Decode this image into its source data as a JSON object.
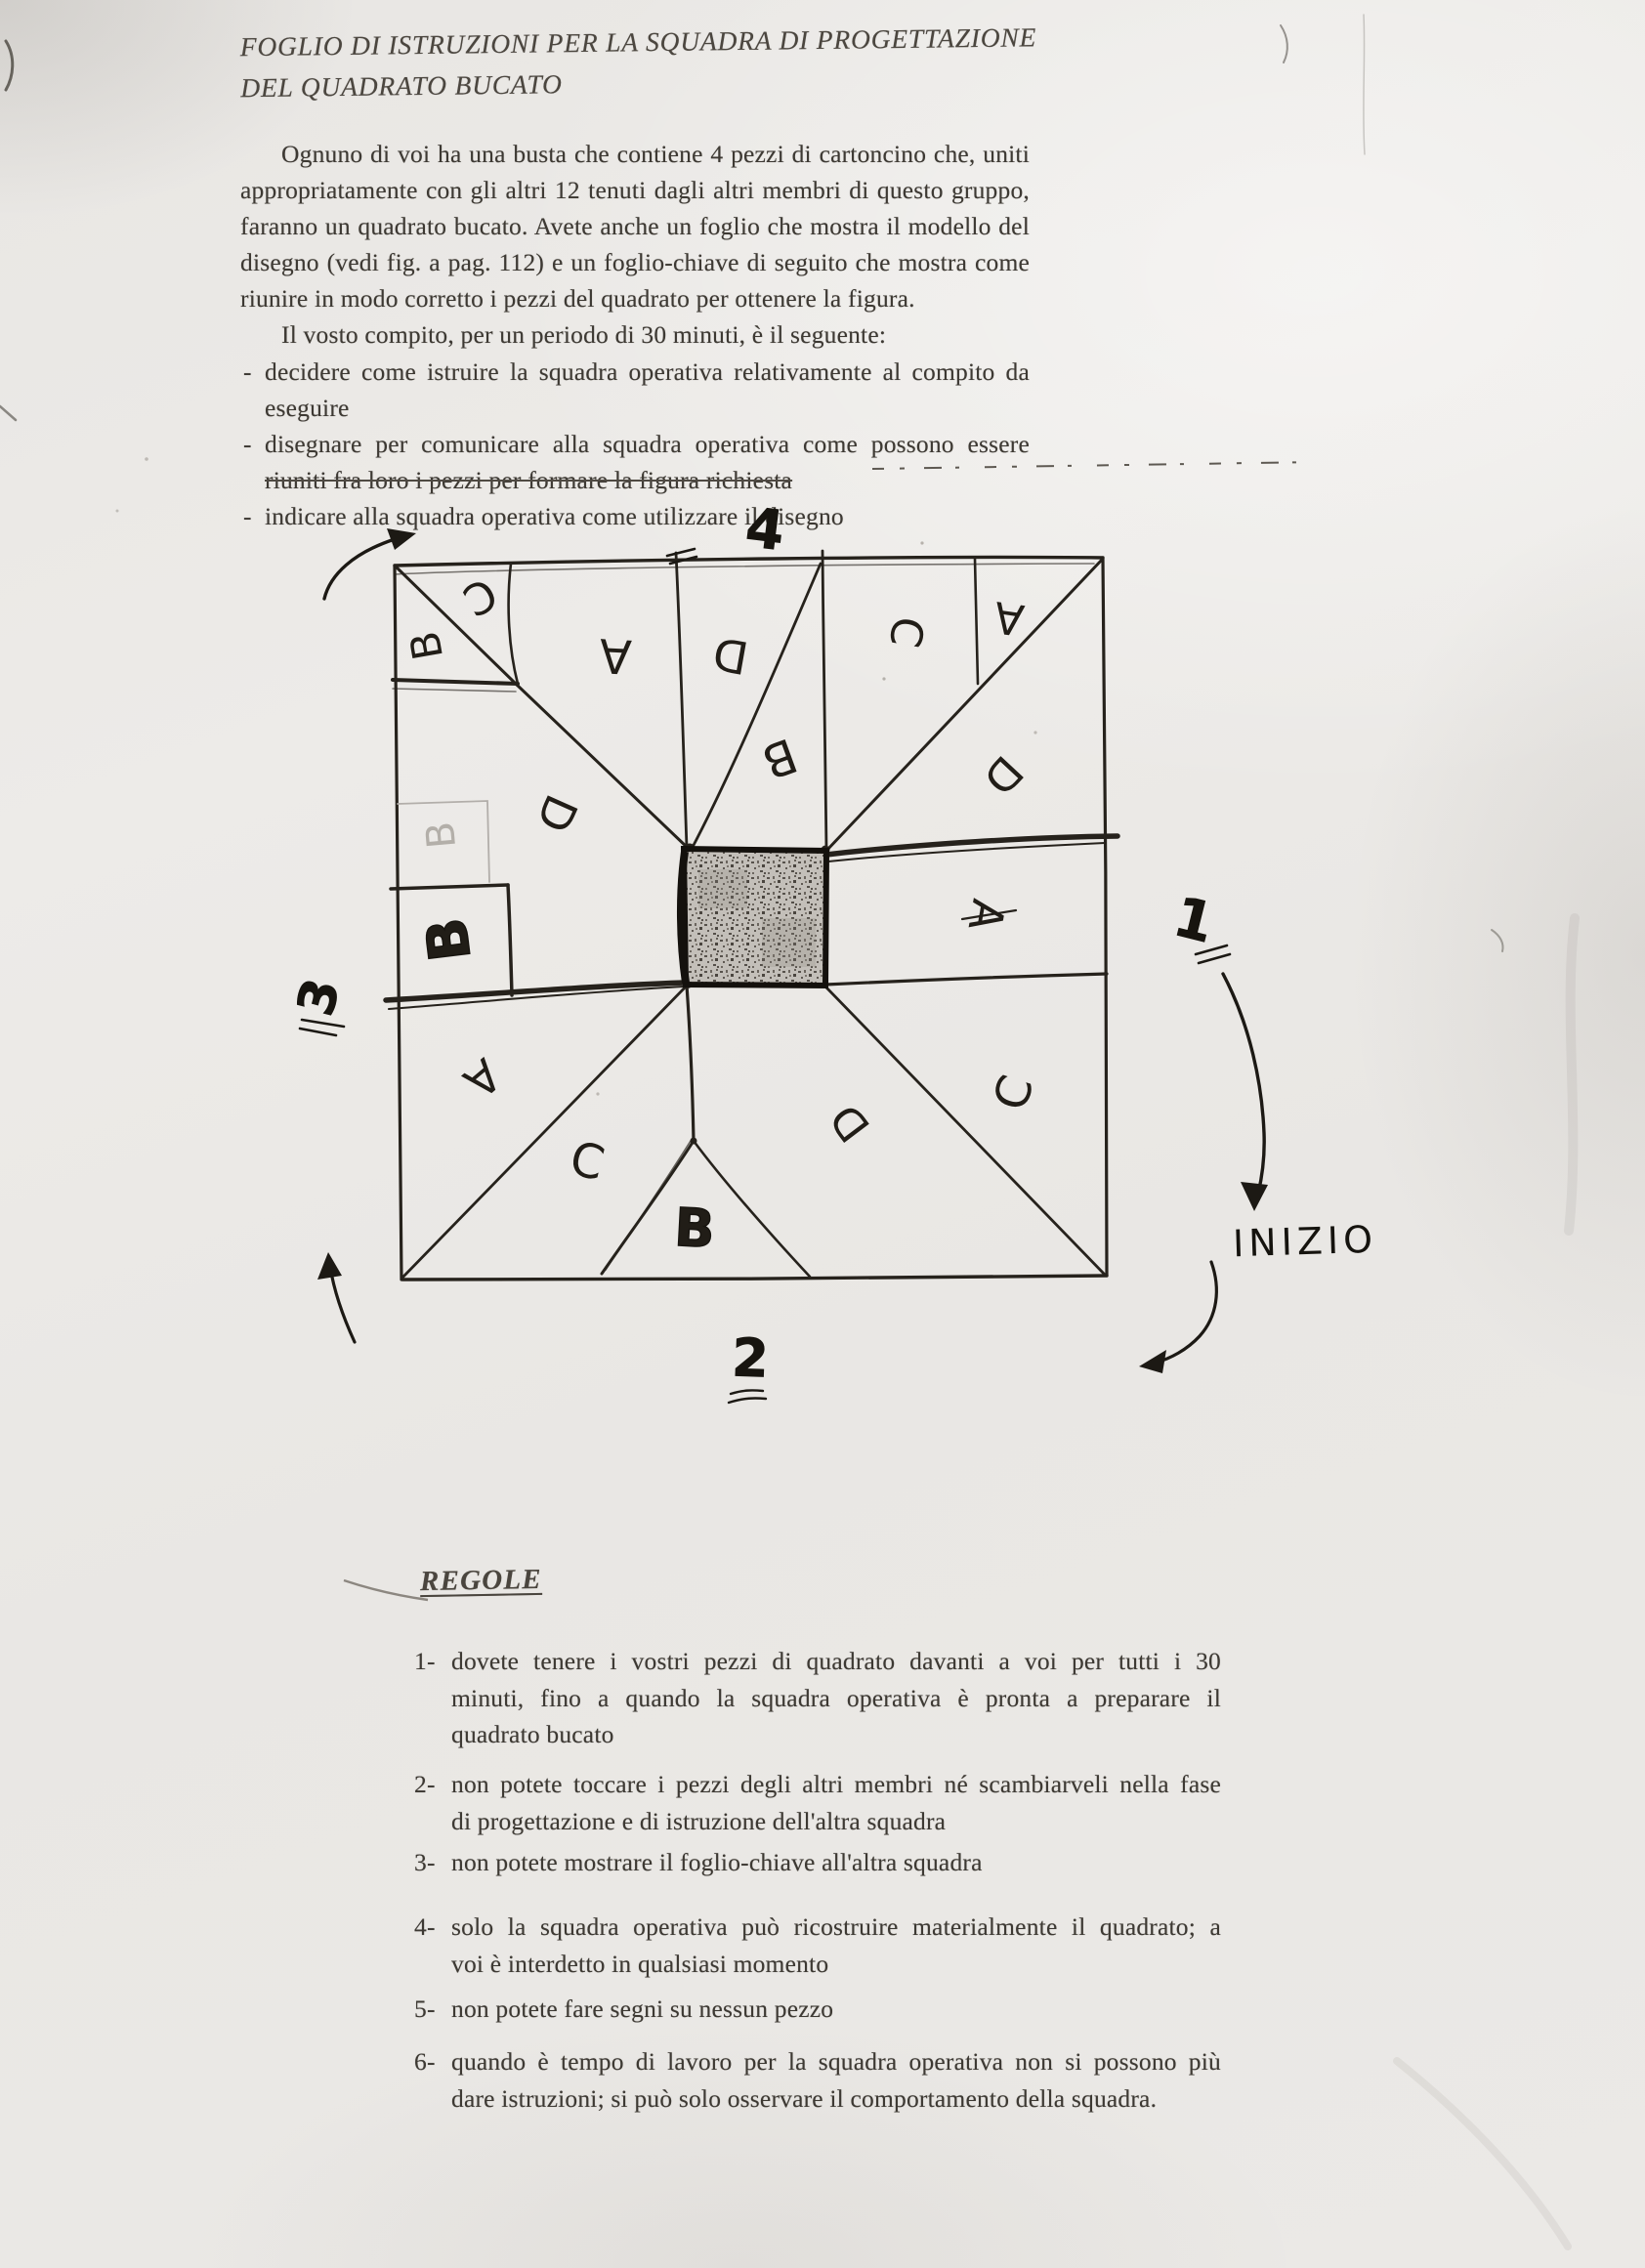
{
  "document": {
    "title": {
      "line1": "FOGLIO DI ISTRUZIONI PER LA SQUADRA DI PROGETTAZIONE",
      "line2": "DEL QUADRATO BUCATO"
    },
    "intro_lines": [
      "Ognuno di voi ha una busta che contiene 4 pezzi di cartoncino che, uniti",
      "appropriatamente con gli altri 12 tenuti dagli altri membri di questo gruppo,",
      "faranno un quadrato bucato. Avete anche un foglio che mostra il modello del",
      "disegno (vedi fig. a pag. 112) e un foglio-chiave di seguito che mostra come",
      "riunire in modo corretto i pezzi del quadrato per ottenere la figura."
    ],
    "task_line": "Il vosto compito, per un periodo di 30 minuti, è il seguente:",
    "bullet_marker": "-",
    "bullets": [
      {
        "line1": "decidere come istruire la squadra operativa relativamente al compito da",
        "line2": "eseguire"
      },
      {
        "line1": "disegnare per comunicare alla squadra operativa come possono essere",
        "line2": "riuniti fra loro i pezzi per formare la figura richiesta"
      },
      {
        "line1": "indicare alla squadra operativa come utilizzare il disegno"
      }
    ]
  },
  "diagram": {
    "labels": [
      {
        "letter": "C"
      },
      {
        "letter": "B"
      },
      {
        "letter": "A"
      },
      {
        "letter": "D"
      },
      {
        "letter": "B"
      },
      {
        "letter": "C"
      },
      {
        "letter": "A"
      },
      {
        "letter": "D"
      },
      {
        "letter": "B"
      },
      {
        "letter": "D"
      },
      {
        "letter": "B"
      },
      {
        "letter": "A"
      },
      {
        "letter": "A"
      },
      {
        "letter": "C"
      },
      {
        "letter": "B"
      },
      {
        "letter": "D"
      },
      {
        "letter": "C"
      }
    ],
    "numbers": {
      "top": "4",
      "right": "1",
      "left": "3",
      "bottom": "2"
    },
    "start_label": "INIZIO"
  },
  "rules": {
    "heading": "REGOLE",
    "items": [
      {
        "num": "1-",
        "lines": [
          "dovete tenere i vostri pezzi di quadrato davanti a voi per tutti i 30",
          "minuti, fino a quando la squadra operativa è pronta a preparare il",
          "quadrato bucato"
        ]
      },
      {
        "num": "2-",
        "lines": [
          "non potete toccare i pezzi degli altri membri né scambiarveli nella fase",
          "di progettazione e di istruzione dell'altra squadra"
        ]
      },
      {
        "num": "3-",
        "lines": [
          "non potete mostrare il foglio-chiave all'altra squadra"
        ]
      },
      {
        "num": "4-",
        "lines": [
          "solo la squadra operativa può ricostruire materialmente il quadrato; a",
          "voi è interdetto in qualsiasi momento"
        ]
      },
      {
        "num": "5-",
        "lines": [
          "non potete fare segni su nessun pezzo"
        ]
      },
      {
        "num": "6-",
        "lines": [
          "quando è tempo di lavoro per la squadra operativa non si possono più",
          "dare istruzioni; si può solo osservare il comportamento della squadra."
        ]
      }
    ]
  }
}
